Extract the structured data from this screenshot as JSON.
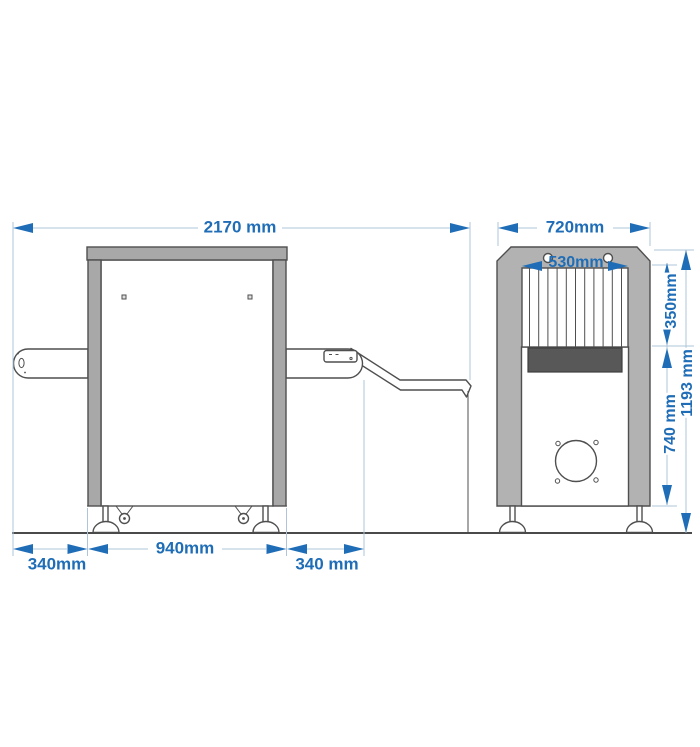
{
  "drawing": {
    "type": "x-ray-baggage-scanner-dimensional-diagram",
    "views": [
      "side-view",
      "end-view"
    ]
  },
  "dims": {
    "overall_length": "2170 mm",
    "overall_width": "720mm",
    "tunnel_width": "530mm",
    "tunnel_height": "350mm",
    "lower_body_height": "740 mm",
    "overall_height": "1193 mm",
    "body_length": "940mm",
    "infeed_extension": "340mm",
    "outfeed_extension": "340 mm"
  },
  "colors": {
    "dimension_accent": "#1f6db6",
    "dimension_line": "#aec4da",
    "machine_gray": "#a8a8a8",
    "machine_body_gray": "#b2b2b2",
    "belt_dark": "#585858",
    "outline": "#4f4f4f",
    "background": "#ffffff"
  }
}
